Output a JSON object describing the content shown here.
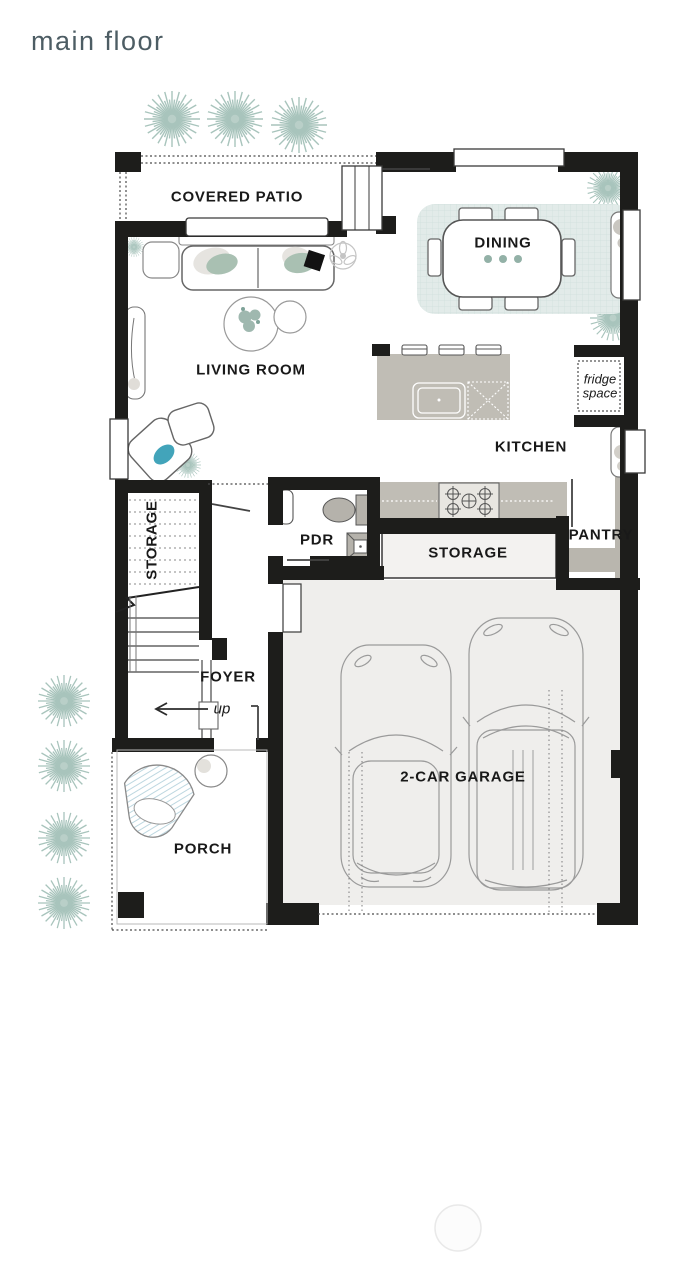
{
  "page": {
    "title": "main floor"
  },
  "floor_plan": {
    "rooms": [
      {
        "name": "covered-patio",
        "label": "COVERED PATIO"
      },
      {
        "name": "dining",
        "label": "DINING"
      },
      {
        "name": "living-room",
        "label": "LIVING ROOM"
      },
      {
        "name": "kitchen",
        "label": "KITCHEN"
      },
      {
        "name": "understair-storage",
        "label": "STORAGE"
      },
      {
        "name": "powder-room",
        "label": "PDR"
      },
      {
        "name": "storage",
        "label": "STORAGE"
      },
      {
        "name": "pantry",
        "label": "PANTRY"
      },
      {
        "name": "foyer",
        "label": "FOYER"
      },
      {
        "name": "porch",
        "label": "PORCH"
      },
      {
        "name": "garage",
        "label": "2-CAR GARAGE"
      }
    ],
    "annotations": {
      "fridge_space": "fridge space",
      "stair_direction": "up"
    },
    "colors": {
      "wall": "#1d1d1b",
      "accent_teal": "#42a4ba",
      "sage": "#a9c0b2",
      "plant": "#a8c4bc",
      "rug": "#e2ebe9",
      "counter": "#c0bdb5",
      "garage_floor": "#efeeec",
      "title_text": "#4d5d64"
    }
  }
}
